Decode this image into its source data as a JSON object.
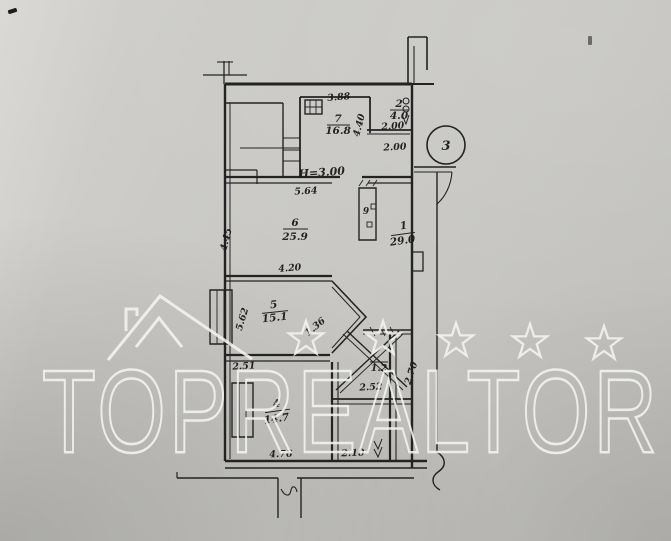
{
  "watermark": {
    "text": "TOPREALTOR",
    "star_count": 5,
    "color": "#f5f5f2"
  },
  "plan": {
    "ink_color": "#232323",
    "paper_color": "#c7c6c2",
    "rooms": [
      {
        "number": "1",
        "area": "29.0"
      },
      {
        "number": "2",
        "area": "4.0"
      },
      {
        "number": "3",
        "area": ""
      },
      {
        "number": "4",
        "area": "14.7"
      },
      {
        "number": "5",
        "area": "15.1"
      },
      {
        "number": "6",
        "area": "25.9"
      },
      {
        "number": "7",
        "area": "16.8"
      },
      {
        "number": "9",
        "area": ""
      },
      {
        "number": "",
        "area": "1.2"
      }
    ],
    "height_note": "Н=3.00",
    "labels": [
      {
        "name": "dim-3-88",
        "text": "3.88",
        "x": 339,
        "y": 100,
        "rot": -5,
        "size": 9.5
      },
      {
        "name": "room7-number",
        "text": "7",
        "x": 338,
        "y": 122,
        "size": 10.5
      },
      {
        "name": "room7-area",
        "text": "16.8",
        "x": 338,
        "y": 134,
        "size": 10.5
      },
      {
        "name": "dim-4-40",
        "text": "4.40",
        "x": 362,
        "y": 126,
        "rot": -75,
        "size": 9.5
      },
      {
        "name": "room2-number",
        "text": "2",
        "x": 399,
        "y": 107,
        "size": 10.5
      },
      {
        "name": "room2-area",
        "text": "4.0",
        "x": 399,
        "y": 119,
        "size": 10.5
      },
      {
        "name": "dim-2-00-a",
        "text": "2.00",
        "x": 393,
        "y": 129,
        "rot": -4,
        "size": 9.5
      },
      {
        "name": "dim-2-00-b",
        "text": "2.00",
        "x": 395,
        "y": 150,
        "rot": -3,
        "size": 9.5
      },
      {
        "name": "balcony-number",
        "text": "3",
        "x": 446,
        "y": 150,
        "size": 13
      },
      {
        "name": "height-note",
        "text": "Н=3.00",
        "x": 322,
        "y": 176,
        "rot": -4,
        "size": 11
      },
      {
        "name": "dim-5-64",
        "text": "5.64",
        "x": 306,
        "y": 194,
        "rot": -3,
        "size": 9.5
      },
      {
        "name": "dim-4-45",
        "text": "4.45",
        "x": 229,
        "y": 240,
        "rot": -76,
        "size": 9.5
      },
      {
        "name": "room6-number",
        "text": "6",
        "x": 295,
        "y": 226,
        "size": 10.5
      },
      {
        "name": "room6-area",
        "text": "25.9",
        "x": 295,
        "y": 240,
        "size": 10.5
      },
      {
        "name": "shaft-number",
        "text": "9",
        "x": 366,
        "y": 214,
        "size": 9
      },
      {
        "name": "room1-number",
        "text": "1",
        "x": 404,
        "y": 229,
        "rot": -8,
        "size": 10.5
      },
      {
        "name": "room1-area",
        "text": "29.0",
        "x": 403,
        "y": 244,
        "rot": -8,
        "size": 10.5
      },
      {
        "name": "dim-4-20",
        "text": "4.20",
        "x": 290,
        "y": 271,
        "rot": -5,
        "size": 9.5
      },
      {
        "name": "dim-5-62",
        "text": "5.62",
        "x": 245,
        "y": 320,
        "rot": -73,
        "size": 9.5
      },
      {
        "name": "room5-number",
        "text": "5",
        "x": 274,
        "y": 308,
        "rot": -6,
        "size": 10.5
      },
      {
        "name": "room5-area",
        "text": "15.1",
        "x": 275,
        "y": 321,
        "rot": -6,
        "size": 10.5
      },
      {
        "name": "dim-1-36",
        "text": "1.36",
        "x": 317,
        "y": 329,
        "rot": -40,
        "size": 9.5
      },
      {
        "name": "dim-2-51",
        "text": "2.51",
        "x": 244,
        "y": 369,
        "rot": -3,
        "size": 9.5
      },
      {
        "name": "room4-number",
        "text": "4",
        "x": 277,
        "y": 407,
        "rot": -8,
        "size": 10.5
      },
      {
        "name": "room4-area",
        "text": "14.7",
        "x": 277,
        "y": 422,
        "rot": -8,
        "size": 10.5
      },
      {
        "name": "wc-area",
        "text": "1.2",
        "x": 379,
        "y": 371,
        "size": 9.5
      },
      {
        "name": "dim-2-52",
        "text": "2.52",
        "x": 371,
        "y": 390,
        "rot": -3,
        "size": 9.5
      },
      {
        "name": "dim-2-70",
        "text": "2.70",
        "x": 414,
        "y": 374,
        "rot": -72,
        "size": 9.5
      },
      {
        "name": "dim-4-76",
        "text": "4.76",
        "x": 281,
        "y": 457,
        "rot": -2,
        "size": 9.5
      },
      {
        "name": "dim-2-10",
        "text": "2.10",
        "x": 353,
        "y": 456,
        "rot": -2,
        "size": 9.5
      }
    ]
  }
}
